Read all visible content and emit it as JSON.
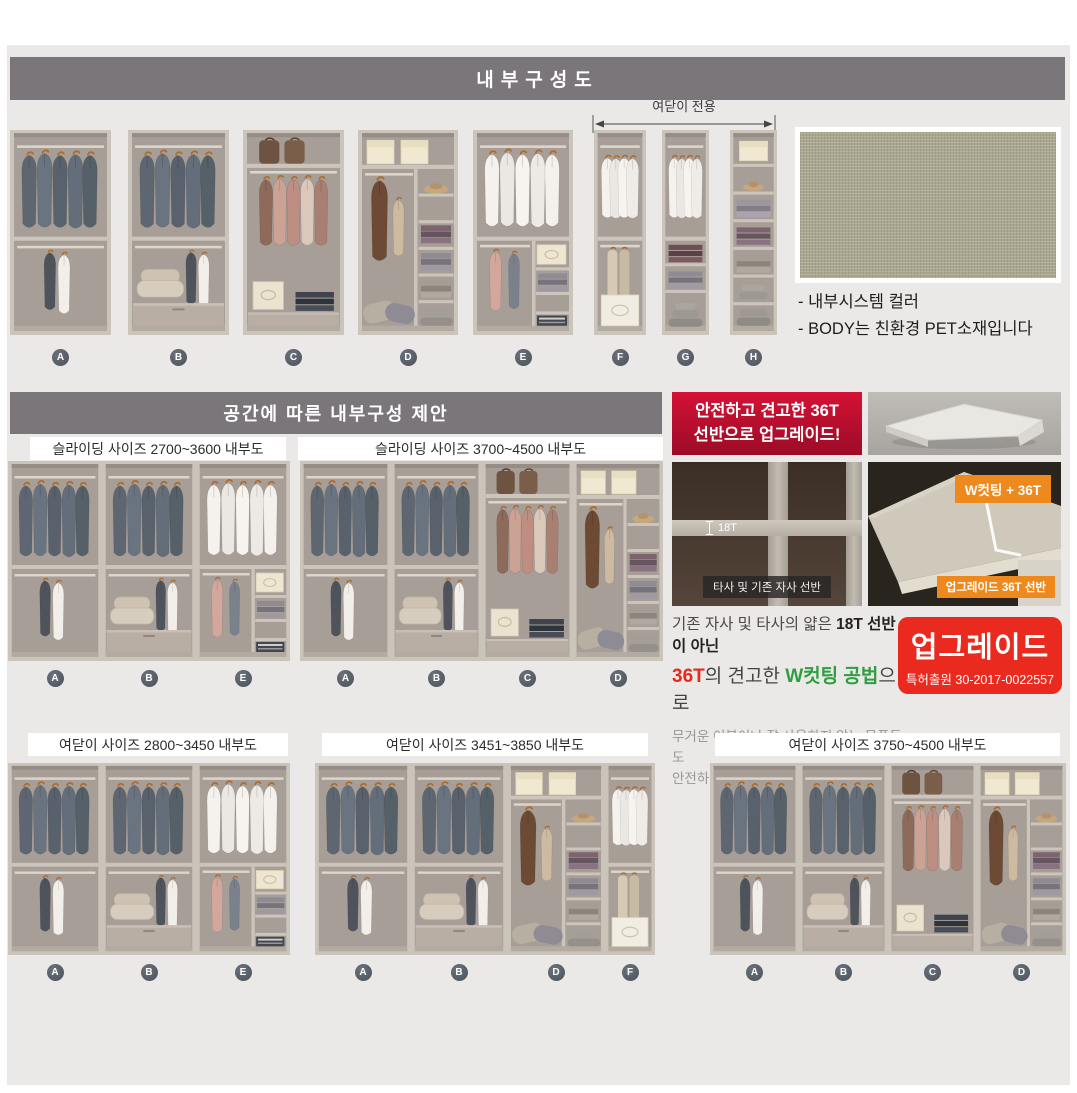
{
  "title_bar": "내부구성도",
  "section2_bar": "공간에 따른 내부구성 제안",
  "top_row": {
    "arrow_label": "여닫이 전용",
    "units": [
      "A",
      "B",
      "C",
      "D",
      "E",
      "F",
      "G",
      "H"
    ]
  },
  "swatch": {
    "notes": [
      "- 내부시스템 컬러",
      "- BODY는 친환경 PET소재입니다"
    ]
  },
  "upgrade_banner": {
    "line1": "안전하고 견고한 36T",
    "line2": "선반으로 업그레이드!"
  },
  "layouts": [
    {
      "label": "슬라이딩 사이즈 2700~3600 내부도",
      "units": [
        "A",
        "B",
        "E"
      ]
    },
    {
      "label": "슬라이딩 사이즈 3700~4500 내부도",
      "units": [
        "A",
        "B",
        "C",
        "D"
      ]
    },
    {
      "label": "여닫이 사이즈 2800~3450 내부도",
      "units": [
        "A",
        "B",
        "E"
      ]
    },
    {
      "label": "여닫이 사이즈 3451~3850 내부도",
      "units": [
        "A",
        "B",
        "D",
        "F"
      ]
    },
    {
      "label": "여닫이 사이즈 3750~4500 내부도",
      "units": [
        "A",
        "B",
        "C",
        "D"
      ]
    }
  ],
  "comparison": {
    "left_photo": {
      "measure_label": "18T",
      "caption": "타사 및 기존 자사 선반"
    },
    "right_photo": {
      "top_badge": "W컷팅 + 36T",
      "caption": "업그레이드 36T 선반"
    },
    "desc": {
      "l1a": "기존 자사 및 타사의 얇은 ",
      "l1b": "18T 선반이 아닌",
      "l2a": "36T",
      "l2b": "의 견고한 ",
      "l2c": "W컷팅 공법",
      "l2d": "으로",
      "l3": "무거운 이불이나 잘 사용하지 않는 물품들도",
      "l4": "안전하게 보관이 가능합니다."
    },
    "patent": {
      "title": "업그레이드",
      "number": "특허출원 30-2017-0022557"
    }
  },
  "colors": {
    "header_bar": "#7b7679",
    "content_bg": "#eae9e8",
    "banner_red_top": "#d41236",
    "banner_red_bottom": "#9c0b26",
    "patent_red": "#ea2a1f",
    "accent_red": "#e8281e",
    "accent_green": "#2f9e41",
    "badge_orange": "#ee8a1d",
    "swatch_khaki": "#a9a78f",
    "letter_badge": "#4b525a"
  }
}
